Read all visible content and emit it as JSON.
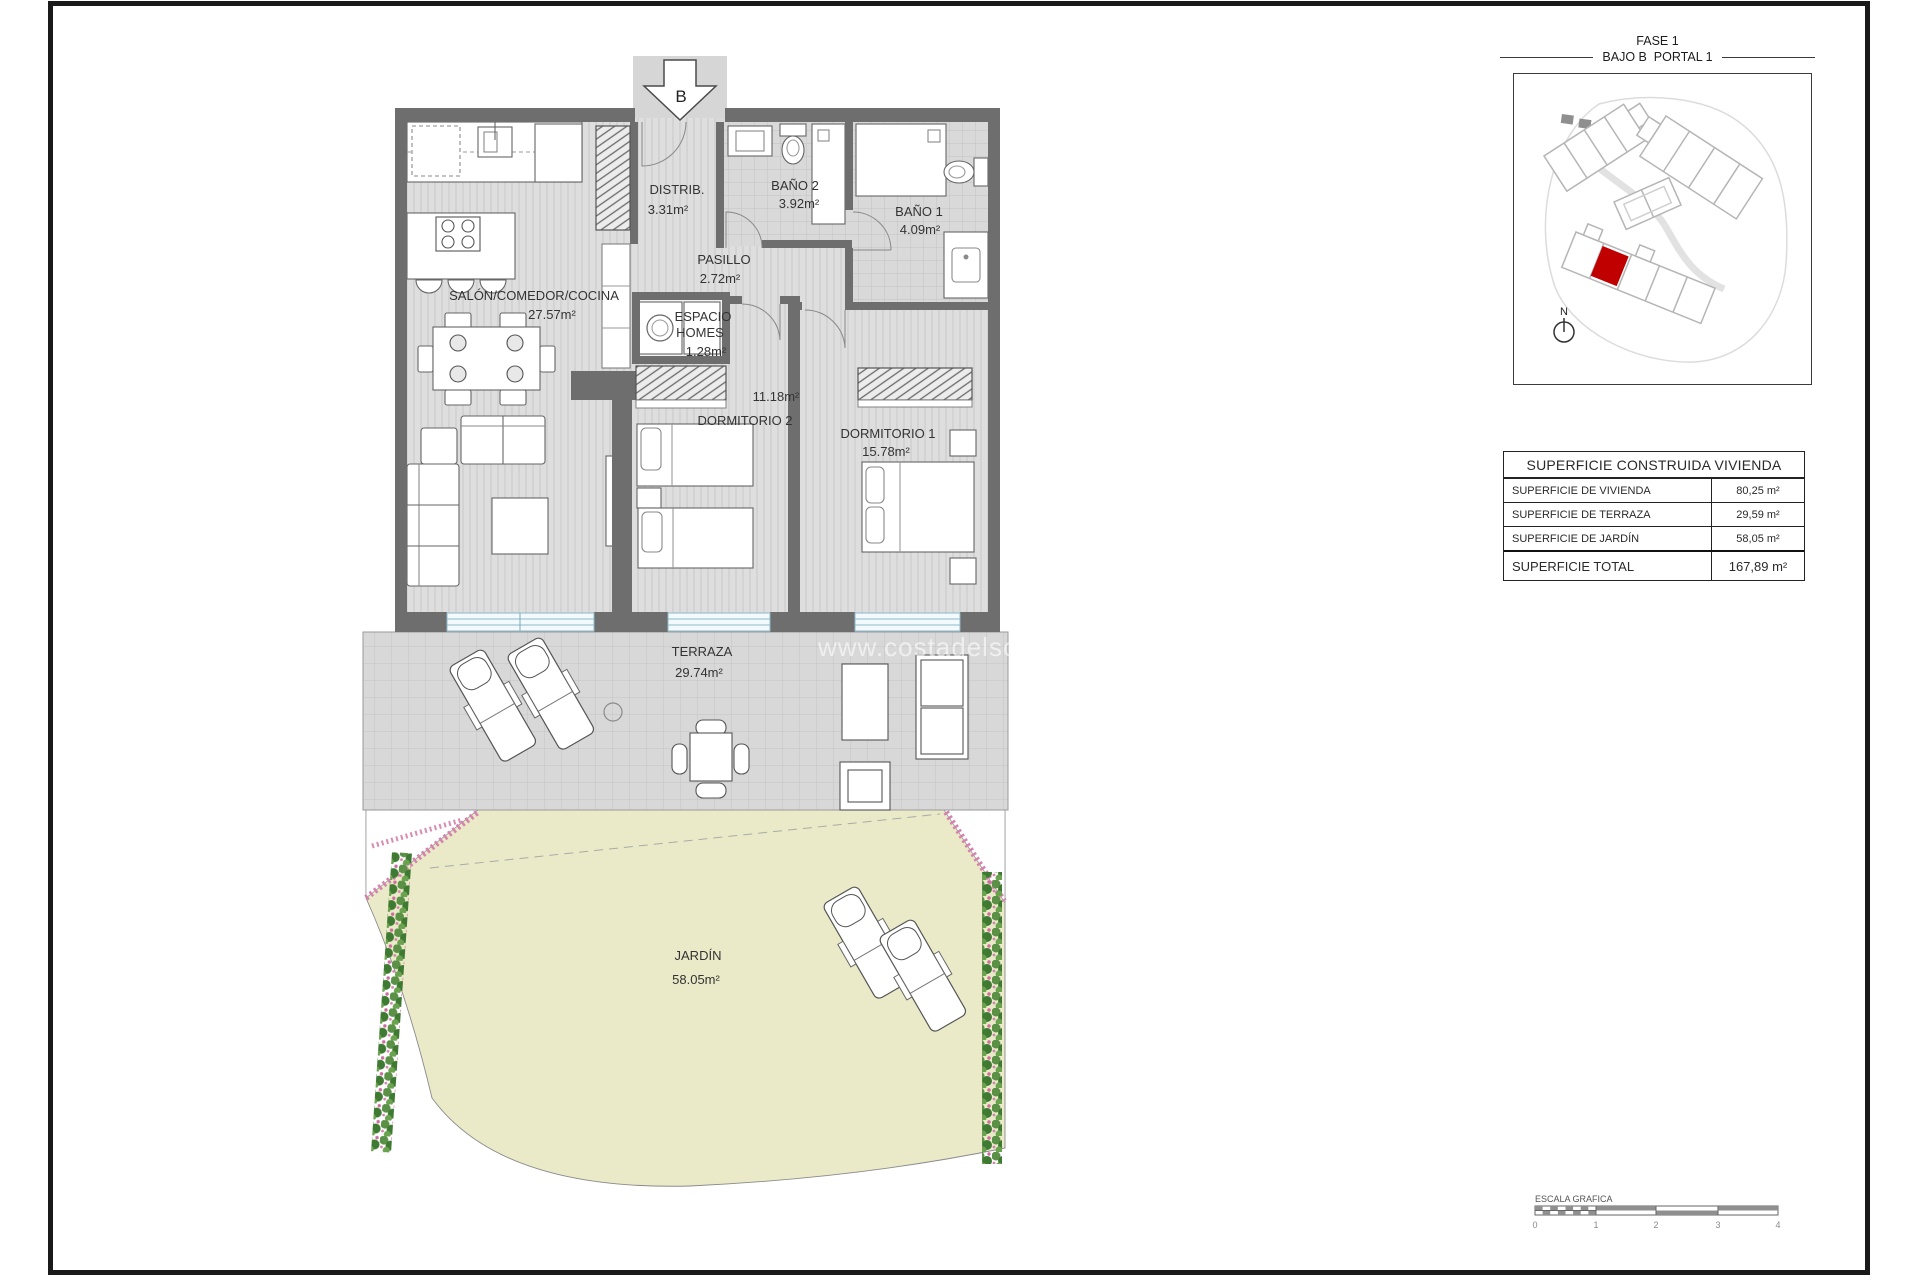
{
  "watermark": "www.costadelsolw",
  "entrance": {
    "label": "B"
  },
  "rooms": {
    "salon": {
      "name": "SALÓN/COMEDOR/COCINA",
      "area": "27.57m²"
    },
    "distrib": {
      "name": "DISTRIB.",
      "area": "3.31m²"
    },
    "bano2": {
      "name": "BAÑO 2",
      "area": "3.92m²"
    },
    "bano1": {
      "name": "BAÑO 1",
      "area": "4.09m²"
    },
    "pasillo": {
      "name": "PASILLO",
      "area": "2.72m²"
    },
    "espacio_homes": {
      "name_line1": "ESPACIO",
      "name_line2": "HOMES",
      "area": "1.28m²"
    },
    "dormitorio2": {
      "name": "DORMITORIO 2",
      "area": "11.18m²"
    },
    "dormitorio1": {
      "name": "DORMITORIO 1",
      "area": "15.78m²"
    },
    "terraza": {
      "name": "TERRAZA",
      "area": "29.74m²"
    },
    "jardin": {
      "name": "JARDÍN",
      "area": "58.05m²"
    }
  },
  "location_panel": {
    "phase": "FASE 1",
    "unit": "BAJO B  PORTAL 1",
    "north_label": "N",
    "highlight_color": "#c00000"
  },
  "area_table": {
    "header": "SUPERFICIE CONSTRUIDA VIVIENDA",
    "rows": [
      {
        "label": "SUPERFICIE DE VIVIENDA",
        "value": "80,25 m²"
      },
      {
        "label": "SUPERFICIE DE TERRAZA",
        "value": "29,59 m²"
      },
      {
        "label": "SUPERFICIE DE JARDÍN",
        "value": "58,05 m²"
      }
    ],
    "total_label": "SUPERFICIE TOTAL",
    "total_value": "167,89 m²"
  },
  "scale_bar": {
    "title": "ESCALA GRAFICA",
    "ticks": [
      "0",
      "1",
      "2",
      "3",
      "4"
    ]
  },
  "colors": {
    "wall": "#6e6e6e",
    "floor": "#dedede",
    "tile": "#d9d9d9",
    "garden": "#eaeac8",
    "hedge": "#4c8a3d",
    "flower": "#d583ae",
    "window_frame": "#8fb9cc",
    "unit_highlight": "#c00000",
    "building_outline": "#b5b5b5"
  }
}
